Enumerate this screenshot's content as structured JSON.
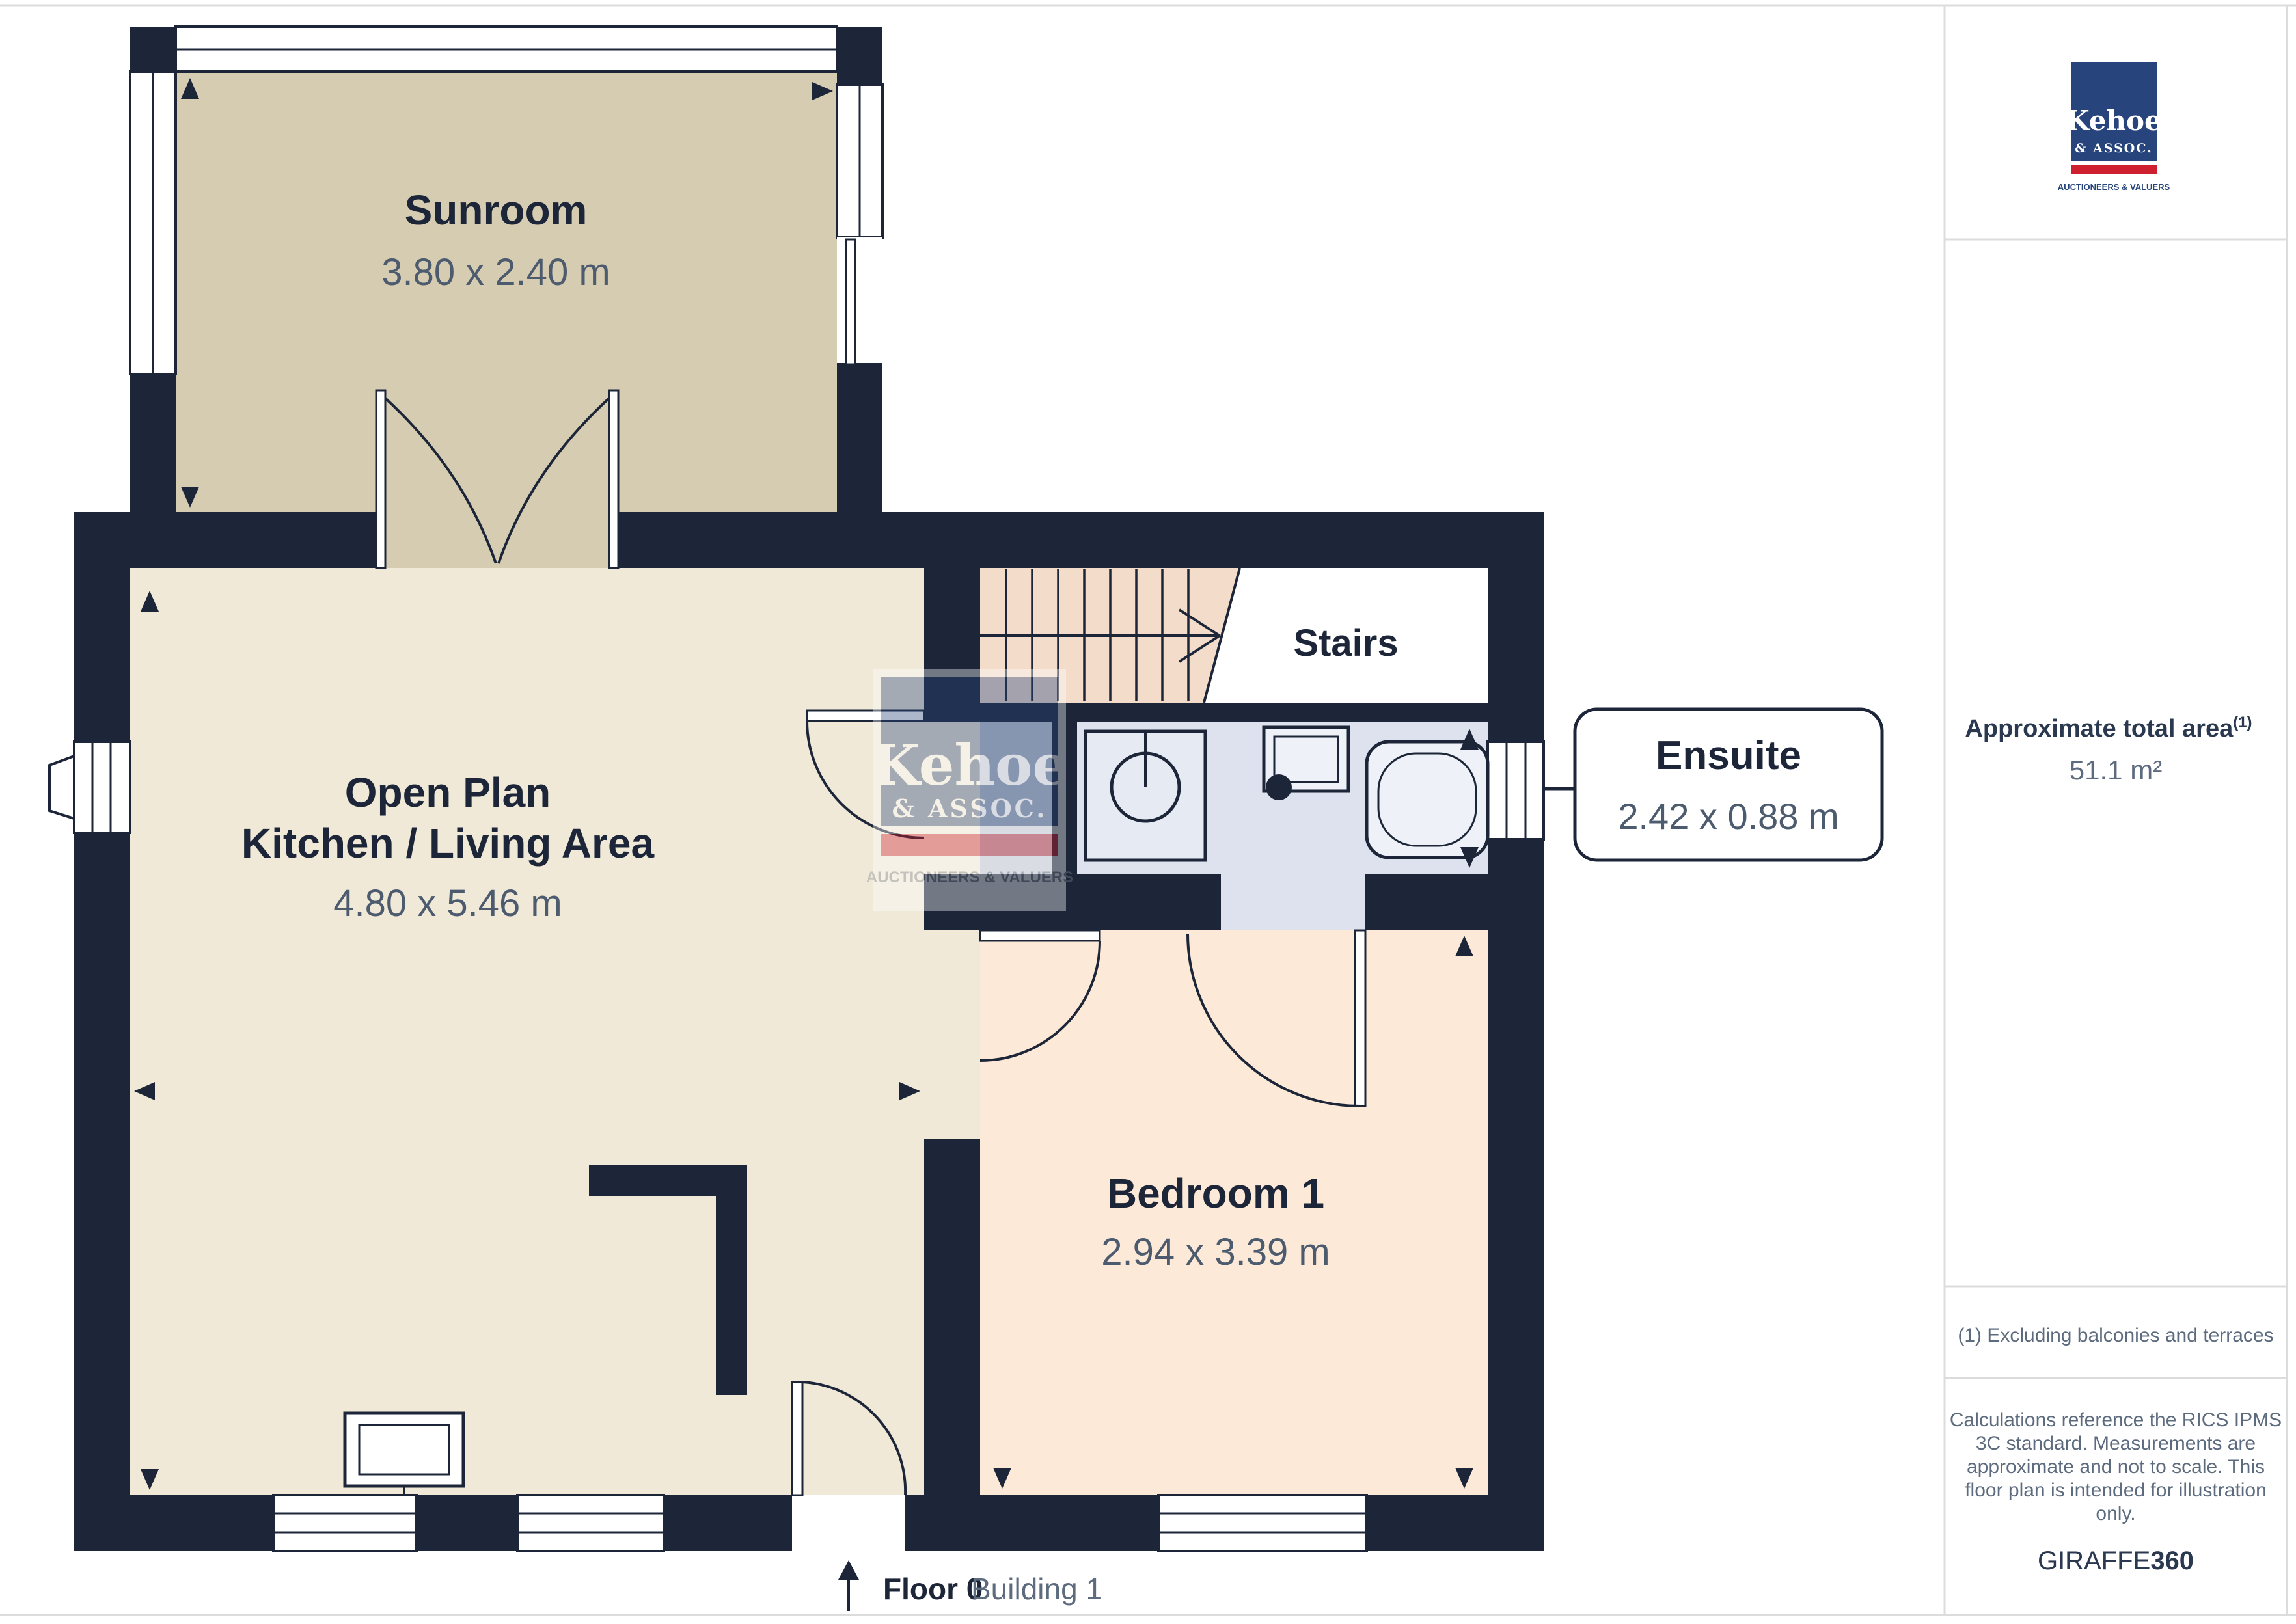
{
  "plan": {
    "rooms": {
      "sunroom": {
        "name": "Sunroom",
        "dims": "3.80 x 2.40 m"
      },
      "kitchen": {
        "line1": "Open Plan",
        "line2": "Kitchen / Living Area",
        "dims": "4.80 x 5.46 m"
      },
      "stairs": {
        "name": "Stairs"
      },
      "ensuite": {
        "name": "Ensuite",
        "dims": "2.42 x 0.88 m"
      },
      "bedroom": {
        "name": "Bedroom 1",
        "dims": "2.94 x 3.39 m"
      }
    },
    "footer": {
      "floor": "Floor 0",
      "building": "Building 1"
    }
  },
  "logo": {
    "name": "Kehoe",
    "assoc": "& ASSOC.",
    "tagline": "AUCTIONEERS & VALUERS"
  },
  "sidebar": {
    "area_label": "Approximate total area",
    "area_superscript": "(1)",
    "area_value": "51.1 m²",
    "footnote": "(1) Excluding balconies and terraces",
    "disclaimer_lines": [
      "Calculations reference the RICS IPMS",
      "3C standard. Measurements are",
      "approximate and not to scale. This",
      "floor plan is intended for illustration",
      "only."
    ],
    "brand": {
      "name": "GIRAFFE",
      "suffix": "360"
    }
  },
  "colors": {
    "wall": "#1c2638",
    "sunroom_floor": "#d6ccb2",
    "kitchen_floor": "#f0e9d8",
    "bedroom_floor": "#fde9d8",
    "ensuite_floor": "#dde2ee",
    "stairs_floor": "#f3dcca",
    "closet_floor": "#c2c7d1",
    "dim_text": "#4d5b6e",
    "logo_navy": "#27457c",
    "logo_red": "#cf2030",
    "divider": "#dcdcdc"
  }
}
